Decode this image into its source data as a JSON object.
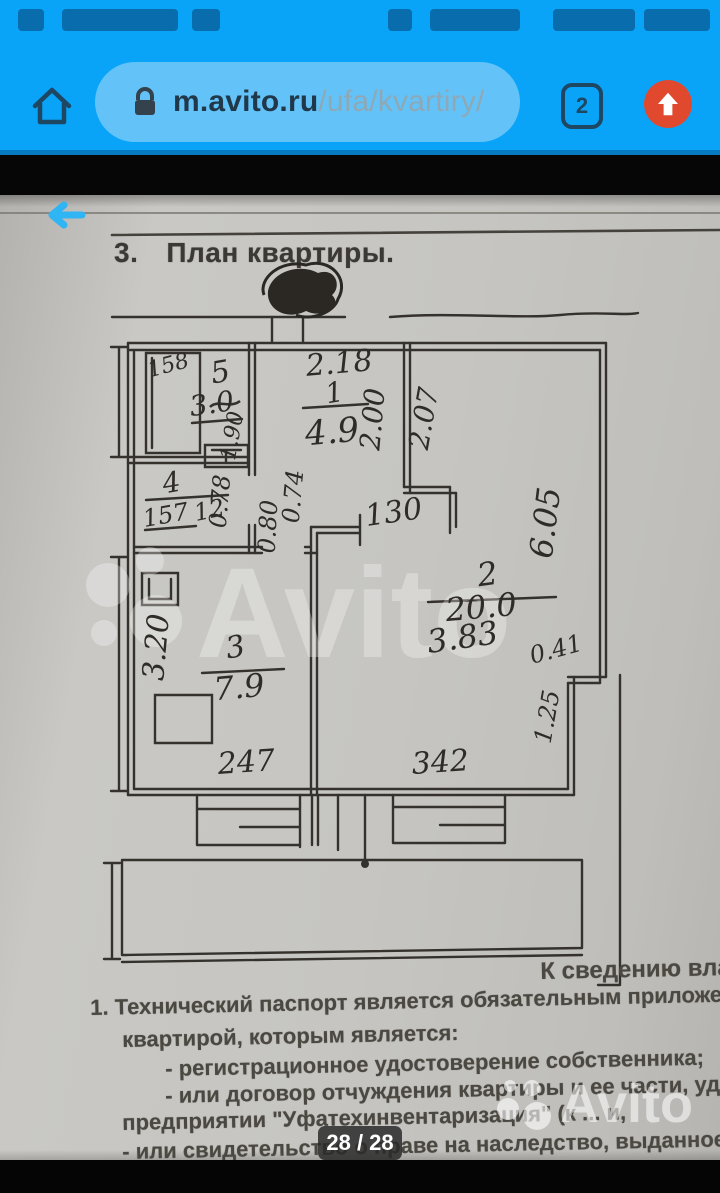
{
  "colors": {
    "browser_accent": "#09a4f8",
    "url_pill": "#63c3f8",
    "icon_navy": "#1d4763",
    "upload_button": "#e1492e",
    "paper": "#c6c5c1",
    "ink": "#35322d",
    "back_arrow": "#2fb4f4"
  },
  "status_bar": {
    "left_icon_names": [
      "notification-icon-cluster"
    ],
    "right_icon_names": [
      "alarm-icon",
      "signal-wifi-icons",
      "battery-icon",
      "clock-digits"
    ]
  },
  "browser": {
    "url_host": "m.avito.ru",
    "url_path": "/ufa/kvartiry/",
    "tab_count": "2"
  },
  "document": {
    "heading_number": "3.",
    "heading_title": "План квартиры.",
    "side_note": "К сведению вла",
    "paragraphs": [
      "1. Технический паспорт является обязательным приложением",
      "квартирой, которым является:",
      "- регистрационное удостоверение собственника;",
      "- или договор отчуждения квартиры и ее части, удост",
      "предприятии \"Уфатехинвентаризация\" (к ... и,",
      "- или свидетельство о праве на наследство, выданное в"
    ],
    "page_indicator": "28 / 28",
    "watermark": "Avito"
  },
  "plan": {
    "labels": [
      {
        "t": "2.18",
        "x": 340,
        "y": 178,
        "r": -5,
        "s": 30
      },
      {
        "t": "1",
        "x": 336,
        "y": 207,
        "r": -10,
        "s": 28
      },
      {
        "t": "4.9",
        "x": 333,
        "y": 248,
        "r": -5,
        "s": 34
      },
      {
        "t": "2.00",
        "x": 382,
        "y": 225,
        "r": -85,
        "s": 28
      },
      {
        "t": "2.07",
        "x": 433,
        "y": 225,
        "r": -80,
        "s": 28
      },
      {
        "t": "130",
        "x": 395,
        "y": 327,
        "r": -8,
        "s": 30
      },
      {
        "t": "158",
        "x": 170,
        "y": 177,
        "r": -15,
        "s": 22
      },
      {
        "t": "5",
        "x": 222,
        "y": 187,
        "r": -10,
        "s": 30
      },
      {
        "t": "3.0",
        "x": 213,
        "y": 218,
        "r": -8,
        "s": 28
      },
      {
        "t": "1.90",
        "x": 239,
        "y": 242,
        "r": -80,
        "s": 22
      },
      {
        "t": "4",
        "x": 173,
        "y": 297,
        "r": -10,
        "s": 28
      },
      {
        "t": "157",
        "x": 167,
        "y": 328,
        "r": -10,
        "s": 24
      },
      {
        "t": "12",
        "x": 211,
        "y": 323,
        "r": -12,
        "s": 24
      },
      {
        "t": "0.78",
        "x": 228,
        "y": 307,
        "r": -85,
        "s": 24
      },
      {
        "t": "0.80",
        "x": 276,
        "y": 332,
        "r": -87,
        "s": 24
      },
      {
        "t": "0.74",
        "x": 301,
        "y": 302,
        "r": -85,
        "s": 24
      },
      {
        "t": "6.05",
        "x": 556,
        "y": 329,
        "r": -83,
        "s": 32
      },
      {
        "t": "2",
        "x": 489,
        "y": 390,
        "r": -8,
        "s": 32
      },
      {
        "t": "20.0",
        "x": 482,
        "y": 423,
        "r": -5,
        "s": 32
      },
      {
        "t": "3.83",
        "x": 464,
        "y": 453,
        "r": -8,
        "s": 32
      },
      {
        "t": "0.41",
        "x": 558,
        "y": 462,
        "r": -15,
        "s": 24
      },
      {
        "t": "1.25",
        "x": 555,
        "y": 523,
        "r": -80,
        "s": 24
      },
      {
        "t": "3.20",
        "x": 166,
        "y": 453,
        "r": -85,
        "s": 30
      },
      {
        "t": "3",
        "x": 237,
        "y": 462,
        "r": -10,
        "s": 30
      },
      {
        "t": "7.9",
        "x": 240,
        "y": 503,
        "r": -5,
        "s": 32
      },
      {
        "t": "247",
        "x": 247,
        "y": 577,
        "r": -4,
        "s": 30
      },
      {
        "t": "342",
        "x": 441,
        "y": 577,
        "r": -4,
        "s": 30
      }
    ]
  }
}
